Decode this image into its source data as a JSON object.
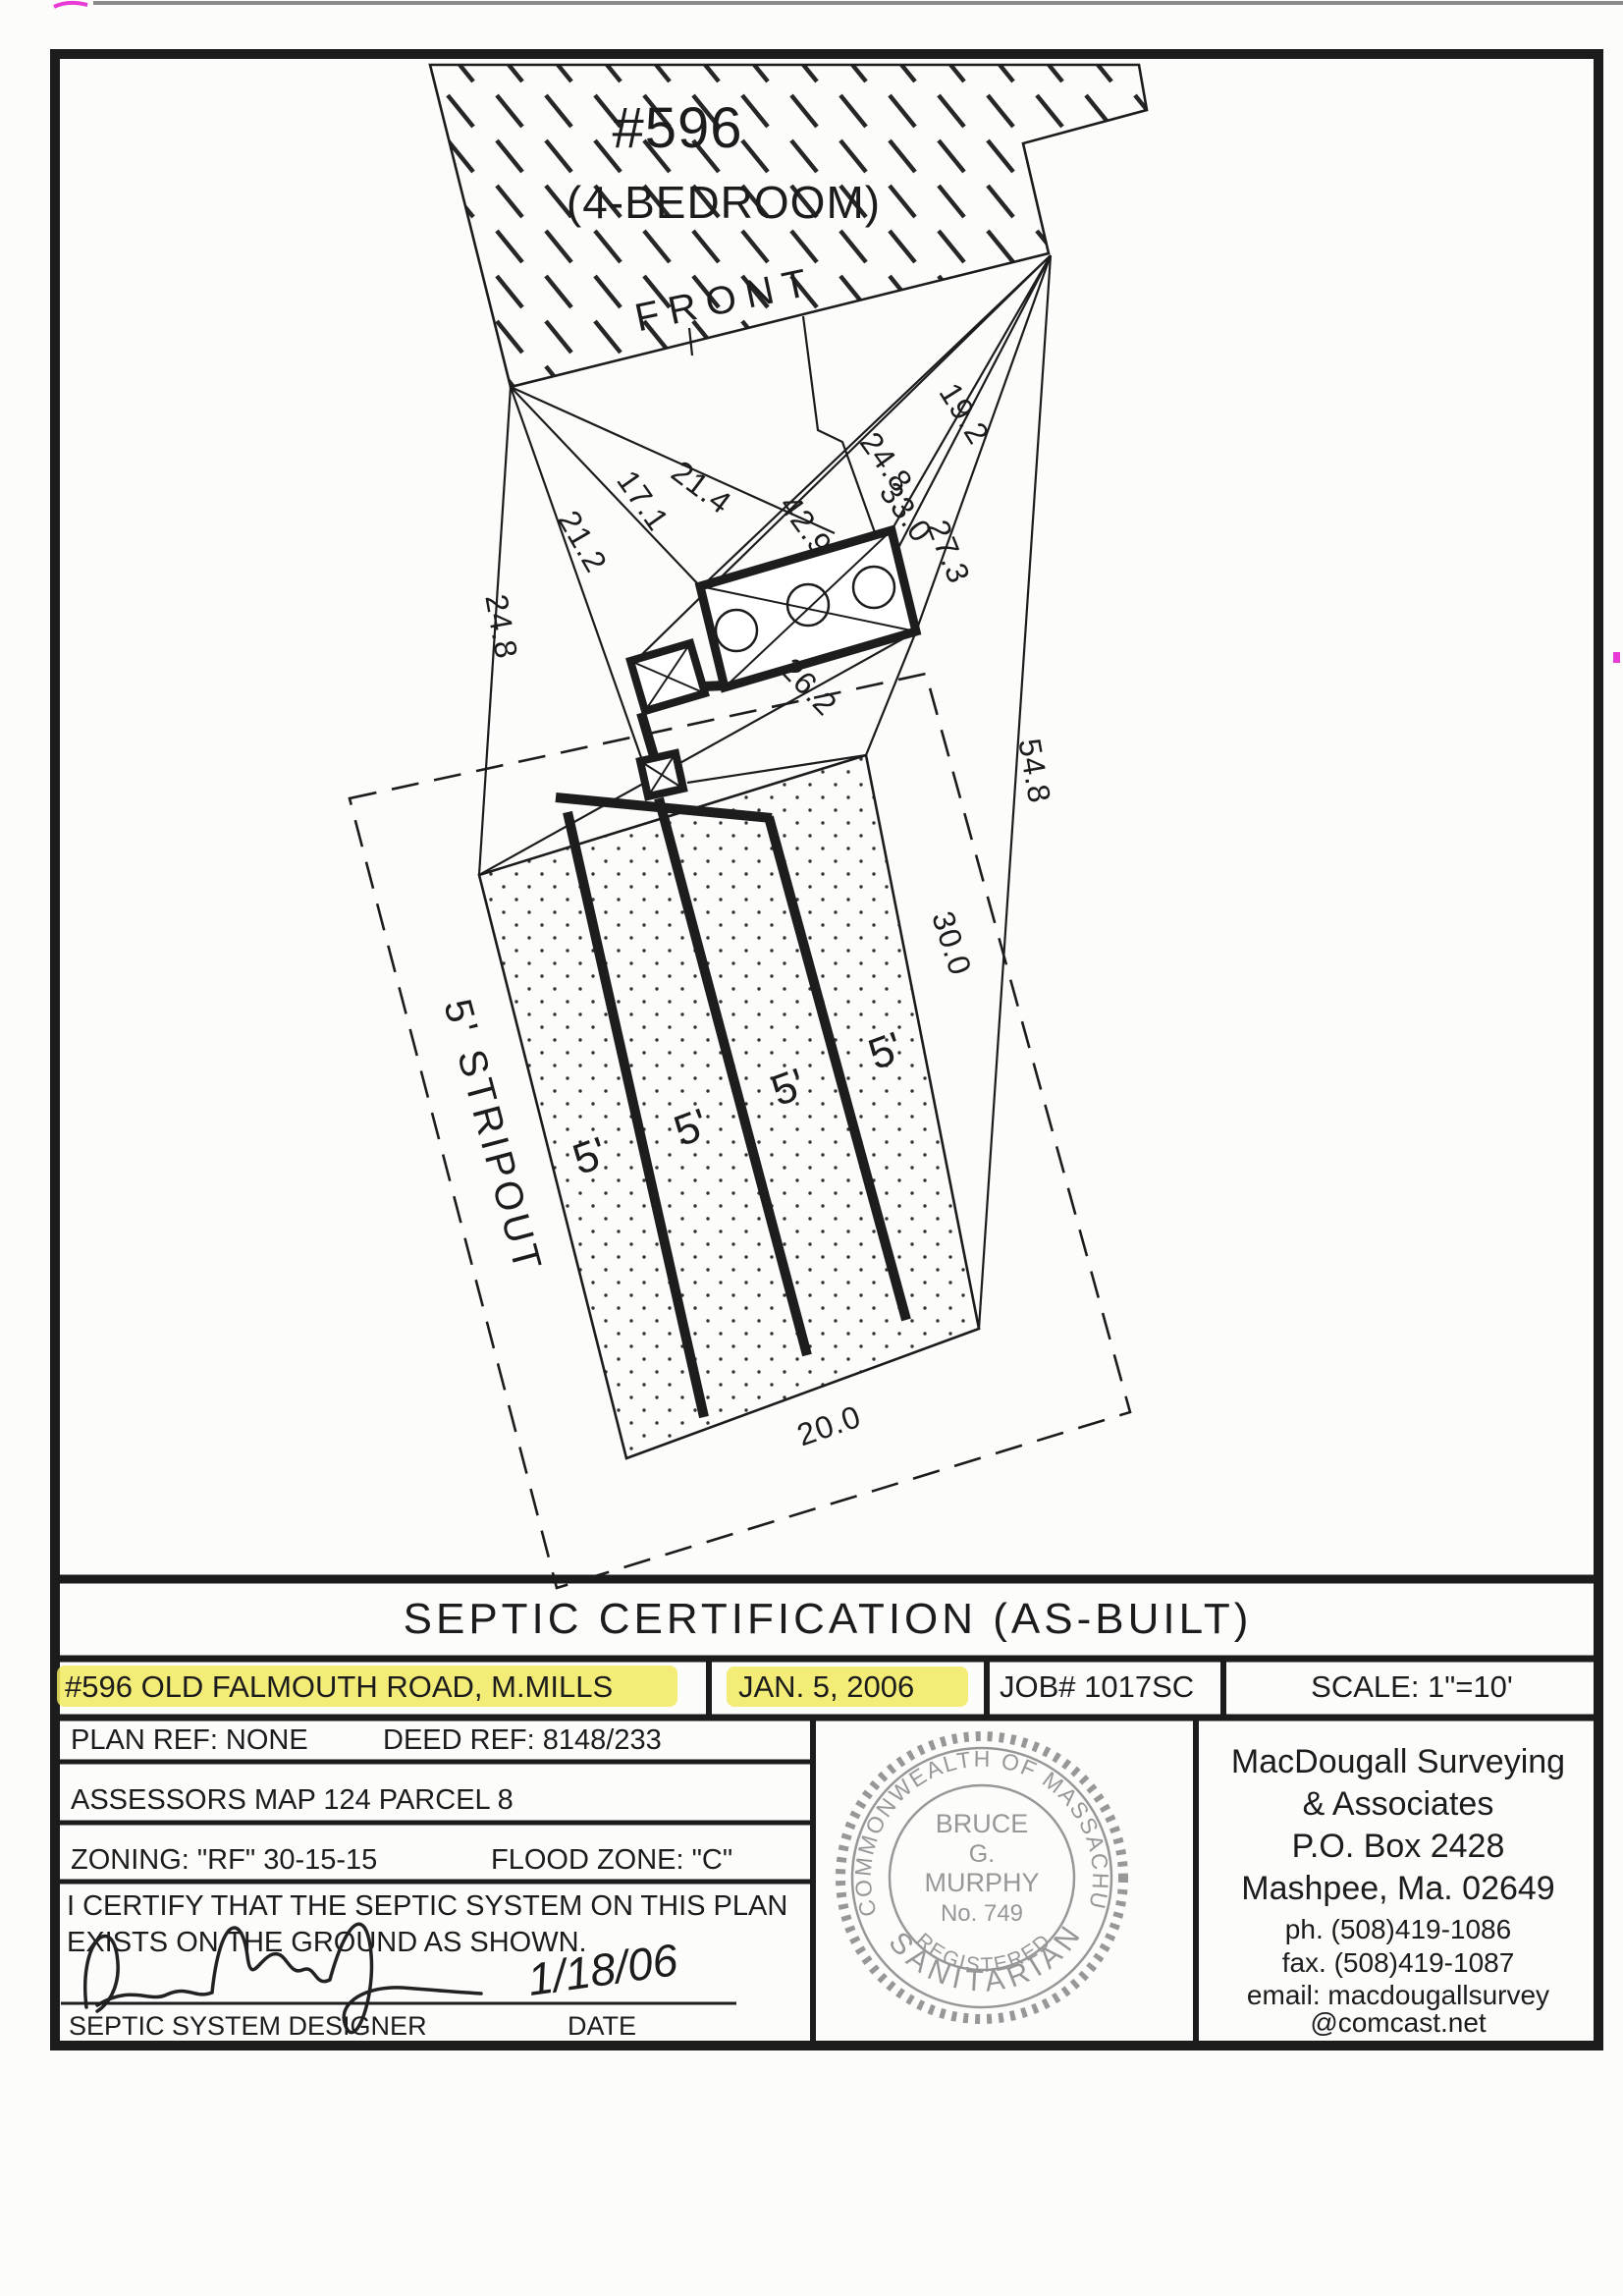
{
  "plan": {
    "house_no": "#596",
    "house_type": "(4-BEDROOM)",
    "front": "FRONT",
    "strip": "5'",
    "stripout": "5' STRIPOUT",
    "dims": {
      "d171": "17.1",
      "d214": "21.4",
      "d212": "21.2",
      "d248l": "24.8",
      "d429": "42.9",
      "d248r": "24.8",
      "d330": "33.0",
      "d192": "19.2",
      "d273": "27.3",
      "d262": "26.2",
      "d548": "54.8",
      "d300": "30.0",
      "d200": "20.0"
    }
  },
  "title": "SEPTIC CERTIFICATION (AS-BUILT)",
  "info": {
    "address": "#596 OLD FALMOUTH ROAD, M.MILLS",
    "date": "JAN. 5, 2006",
    "job": "JOB# 1017SC",
    "scale": "SCALE: 1\"=10'",
    "plan_ref": "PLAN REF: NONE",
    "deed_ref": "DEED REF: 8148/233",
    "assessors": "ASSESSORS MAP 124 PARCEL 8",
    "zoning": "ZONING: \"RF\" 30-15-15",
    "flood": "FLOOD ZONE: \"C\"",
    "cert1": "I CERTIFY THAT THE SEPTIC SYSTEM ON THIS PLAN",
    "cert2": "EXISTS ON THE GROUND AS SHOWN.",
    "sig_date": "1/18/06",
    "designer_label": "SEPTIC SYSTEM DESIGNER",
    "date_label": "DATE"
  },
  "stamp": {
    "outer": "COMMONWEALTH OF MASSACHUSETTS",
    "name1": "BRUCE",
    "name2": "G.",
    "name3": "MURPHY",
    "number": "No. 749",
    "registered": "REGISTERED",
    "bottom": "SANITARIAN"
  },
  "firm": {
    "l1": "MacDougall Surveying",
    "l2": "& Associates",
    "l3": "P.O. Box 2428",
    "l4": "Mashpee, Ma. 02649",
    "ph": "ph. (508)419-1086",
    "fax": "fax. (508)419-1087",
    "em1": "email: macdougallsurvey",
    "em2": "@comcast.net"
  },
  "colors": {
    "highlight": "#f1e95f",
    "stamp_gray": "#8d8d8d",
    "artifact_pink": "#e83ad5"
  }
}
